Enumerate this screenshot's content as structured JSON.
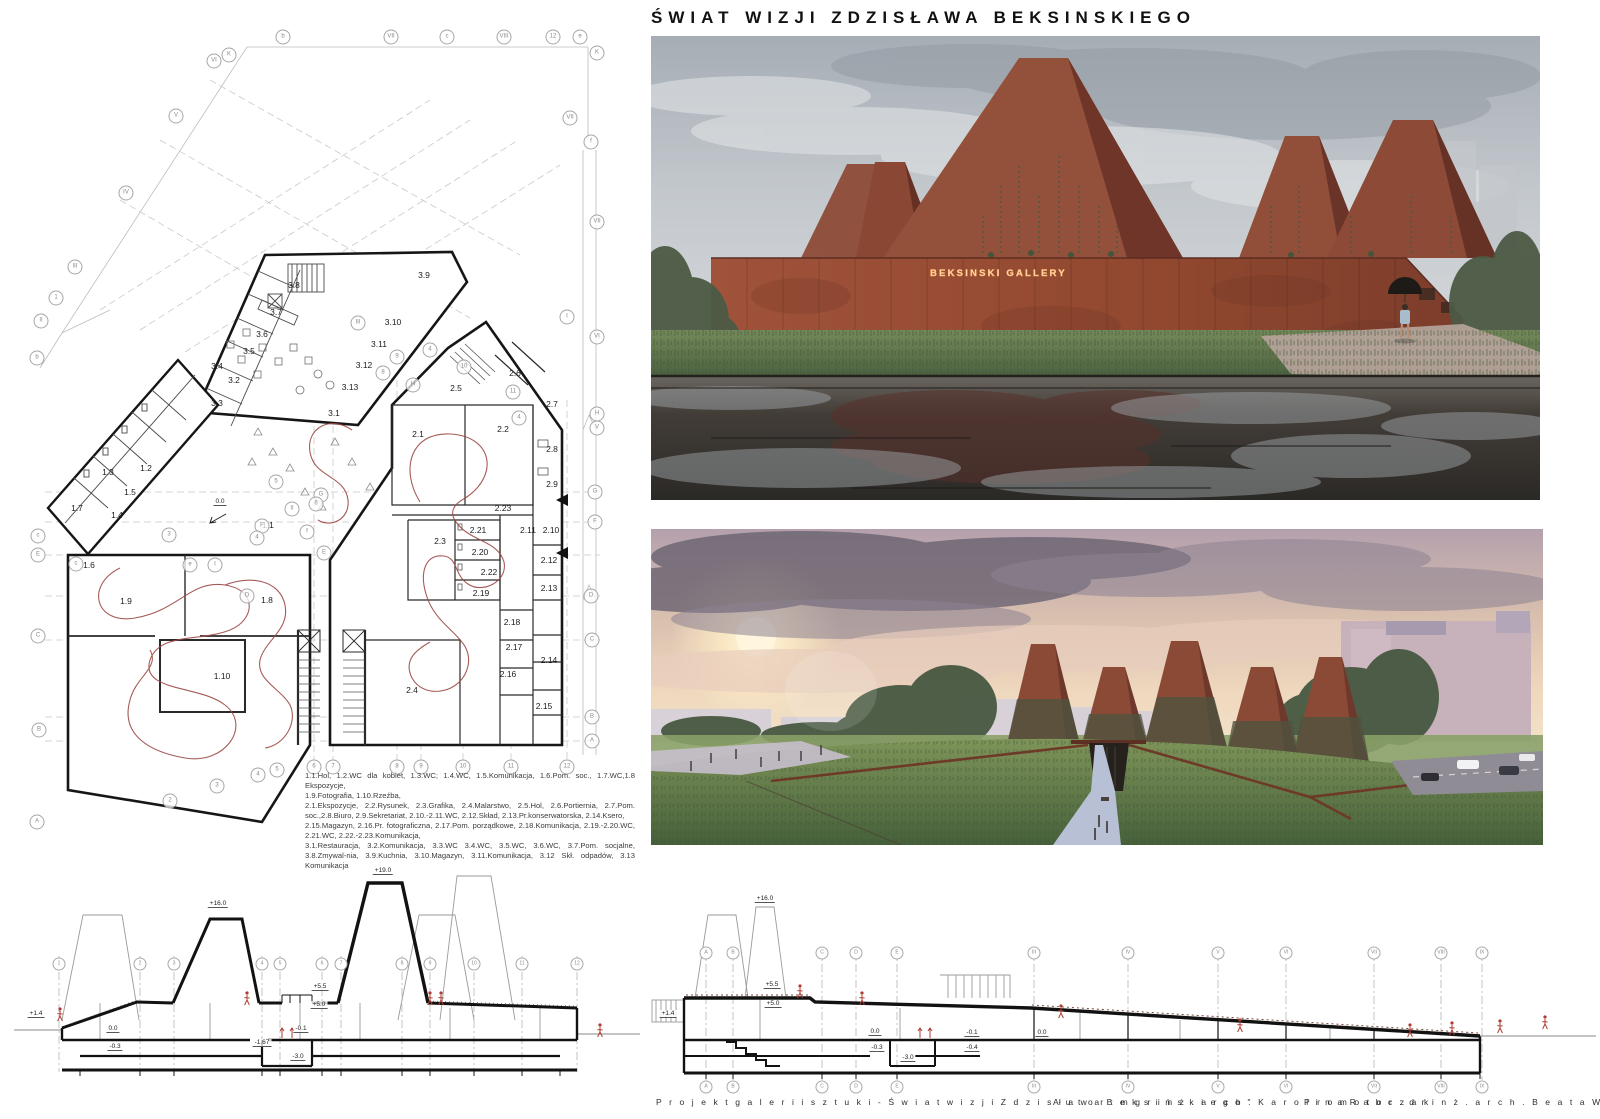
{
  "title": "ŚWIAT WIZJI ZDZISŁAWA BEKSINSKIEGO",
  "renders": {
    "gallery_sign": "BEKSINSKI GALLERY"
  },
  "footer": {
    "project": "P r o j e k t   g a l e r i i   s z t u k i -   Ś w i a t   w i z j i   Z d z i s ł a w a   B e k s i ń s k i e g o \"",
    "author": "A u t o r :   m g r   i n ż .   a r c h .   K a r o l i n a   R a b c z a k",
    "promoter": "P r o m o t o r :   d r   i n ż .   a r c h .   B e a t a   W a l i c k a - G ó r a l"
  },
  "plan": {
    "entry_level": "0.0",
    "rooms": [
      {
        "t": "3.8",
        "x": 294,
        "y": 285
      },
      {
        "t": "3.9",
        "x": 424,
        "y": 275
      },
      {
        "t": "3.7",
        "x": 276,
        "y": 312
      },
      {
        "t": "3.10",
        "x": 393,
        "y": 322
      },
      {
        "t": "3.6",
        "x": 262,
        "y": 334
      },
      {
        "t": "3.11",
        "x": 379,
        "y": 344
      },
      {
        "t": "3.5",
        "x": 249,
        "y": 351
      },
      {
        "t": "3.12",
        "x": 364,
        "y": 365
      },
      {
        "t": "3.4",
        "x": 217,
        "y": 366
      },
      {
        "t": "3.2",
        "x": 234,
        "y": 380
      },
      {
        "t": "3.13",
        "x": 350,
        "y": 387
      },
      {
        "t": "3.3",
        "x": 217,
        "y": 403
      },
      {
        "t": "3.1",
        "x": 334,
        "y": 413
      },
      {
        "t": "1.3",
        "x": 108,
        "y": 472
      },
      {
        "t": "1.2",
        "x": 146,
        "y": 468
      },
      {
        "t": "1.5",
        "x": 130,
        "y": 492
      },
      {
        "t": "1.7",
        "x": 77,
        "y": 508
      },
      {
        "t": "1.4",
        "x": 117,
        "y": 515
      },
      {
        "t": "1.6",
        "x": 89,
        "y": 565
      },
      {
        "t": "1.1",
        "x": 268,
        "y": 525
      },
      {
        "t": "1.9",
        "x": 126,
        "y": 601
      },
      {
        "t": "1.8",
        "x": 267,
        "y": 600
      },
      {
        "t": "1.10",
        "x": 222,
        "y": 676
      },
      {
        "t": "2.1",
        "x": 418,
        "y": 434
      },
      {
        "t": "2.2",
        "x": 503,
        "y": 429
      },
      {
        "t": "2.5",
        "x": 456,
        "y": 388
      },
      {
        "t": "2.6",
        "x": 515,
        "y": 373
      },
      {
        "t": "2.7",
        "x": 552,
        "y": 404
      },
      {
        "t": "2.8",
        "x": 552,
        "y": 449
      },
      {
        "t": "2.9",
        "x": 552,
        "y": 484
      },
      {
        "t": "2.23",
        "x": 503,
        "y": 508
      },
      {
        "t": "2.21",
        "x": 478,
        "y": 530
      },
      {
        "t": "2.3",
        "x": 440,
        "y": 541
      },
      {
        "t": "2.11",
        "x": 528,
        "y": 530
      },
      {
        "t": "2.10",
        "x": 551,
        "y": 530
      },
      {
        "t": "2.20",
        "x": 480,
        "y": 552
      },
      {
        "t": "2.22",
        "x": 489,
        "y": 572
      },
      {
        "t": "2.12",
        "x": 549,
        "y": 560
      },
      {
        "t": "2.19",
        "x": 481,
        "y": 593
      },
      {
        "t": "2.13",
        "x": 549,
        "y": 588
      },
      {
        "t": "2.18",
        "x": 512,
        "y": 622
      },
      {
        "t": "2.17",
        "x": 514,
        "y": 647
      },
      {
        "t": "2.16",
        "x": 508,
        "y": 674
      },
      {
        "t": "2.14",
        "x": 549,
        "y": 660
      },
      {
        "t": "2.4",
        "x": 412,
        "y": 690
      },
      {
        "t": "2.15",
        "x": 544,
        "y": 706
      }
    ],
    "bubbles": [
      {
        "t": "VI",
        "x": 214,
        "y": 61
      },
      {
        "t": "K",
        "x": 229,
        "y": 55
      },
      {
        "t": "b",
        "x": 283,
        "y": 37
      },
      {
        "t": "VII",
        "x": 391,
        "y": 37
      },
      {
        "t": "c",
        "x": 447,
        "y": 37
      },
      {
        "t": "VIII",
        "x": 504,
        "y": 37
      },
      {
        "t": "12",
        "x": 553,
        "y": 37
      },
      {
        "t": "e",
        "x": 580,
        "y": 37
      },
      {
        "t": "K",
        "x": 597,
        "y": 53
      },
      {
        "t": "V",
        "x": 176,
        "y": 116
      },
      {
        "t": "IV",
        "x": 126,
        "y": 193
      },
      {
        "t": "III",
        "x": 75,
        "y": 267
      },
      {
        "t": "1",
        "x": 56,
        "y": 298
      },
      {
        "t": "II",
        "x": 41,
        "y": 321
      },
      {
        "t": "b",
        "x": 37,
        "y": 358
      },
      {
        "t": "c",
        "x": 38,
        "y": 536
      },
      {
        "t": "E",
        "x": 38,
        "y": 555
      },
      {
        "t": "C",
        "x": 38,
        "y": 636
      },
      {
        "t": "B",
        "x": 39,
        "y": 730
      },
      {
        "t": "A",
        "x": 37,
        "y": 822
      },
      {
        "t": "VII",
        "x": 570,
        "y": 118
      },
      {
        "t": "f",
        "x": 591,
        "y": 142
      },
      {
        "t": "VII",
        "x": 597,
        "y": 222
      },
      {
        "t": "I",
        "x": 567,
        "y": 317
      },
      {
        "t": "VI",
        "x": 597,
        "y": 337
      },
      {
        "t": "H",
        "x": 597,
        "y": 414
      },
      {
        "t": "V",
        "x": 597,
        "y": 428
      },
      {
        "t": "G",
        "x": 595,
        "y": 492
      },
      {
        "t": "F",
        "x": 595,
        "y": 522
      },
      {
        "t": "D",
        "x": 591,
        "y": 596
      },
      {
        "t": "C",
        "x": 592,
        "y": 640
      },
      {
        "t": "B",
        "x": 592,
        "y": 717
      },
      {
        "t": "A",
        "x": 592,
        "y": 741
      },
      {
        "t": "2",
        "x": 170,
        "y": 801
      },
      {
        "t": "3",
        "x": 217,
        "y": 786
      },
      {
        "t": "4",
        "x": 258,
        "y": 775
      },
      {
        "t": "5",
        "x": 277,
        "y": 770
      },
      {
        "t": "6",
        "x": 314,
        "y": 767
      },
      {
        "t": "7",
        "x": 333,
        "y": 767
      },
      {
        "t": "8",
        "x": 397,
        "y": 767
      },
      {
        "t": "9",
        "x": 421,
        "y": 767
      },
      {
        "t": "10",
        "x": 463,
        "y": 767
      },
      {
        "t": "11",
        "x": 511,
        "y": 767
      },
      {
        "t": "12",
        "x": 567,
        "y": 767
      },
      {
        "t": "5",
        "x": 276,
        "y": 482
      },
      {
        "t": "II",
        "x": 292,
        "y": 509
      },
      {
        "t": "G",
        "x": 321,
        "y": 495
      },
      {
        "t": "6",
        "x": 316,
        "y": 504
      },
      {
        "t": "F",
        "x": 262,
        "y": 526
      },
      {
        "t": "4",
        "x": 257,
        "y": 538
      },
      {
        "t": "f",
        "x": 307,
        "y": 532
      },
      {
        "t": "E",
        "x": 324,
        "y": 553
      },
      {
        "t": "e",
        "x": 190,
        "y": 565
      },
      {
        "t": "I",
        "x": 215,
        "y": 565
      },
      {
        "t": "3",
        "x": 169,
        "y": 535
      },
      {
        "t": "D",
        "x": 247,
        "y": 596
      },
      {
        "t": "c",
        "x": 76,
        "y": 564
      },
      {
        "t": "9",
        "x": 397,
        "y": 357
      },
      {
        "t": "8",
        "x": 383,
        "y": 373
      },
      {
        "t": "4",
        "x": 430,
        "y": 350
      },
      {
        "t": "10",
        "x": 464,
        "y": 367
      },
      {
        "t": "11",
        "x": 513,
        "y": 392
      },
      {
        "t": "4",
        "x": 519,
        "y": 418
      },
      {
        "t": "H",
        "x": 413,
        "y": 385
      },
      {
        "t": "III",
        "x": 358,
        "y": 323
      }
    ],
    "levels": [
      {
        "t": "0.0",
        "x": 220,
        "y": 506
      }
    ],
    "legend": [
      {
        "t": "1.1.Hol,  1.2.WC  dla kobiet,  1.3.WC;  1.4.WC,  1.5.Komunikacja,  1.6.Pom.  soc.,  1.7.WC,1.8  Ekspozycje,"
      },
      {
        "t": "1.9.Fotografia, 1.10.Rzeźba,"
      },
      {
        "t": "2.1.Ekspozycje,  2.2.Rysunek,  2.3.Grafika,  2.4.Malarstwo,  2.5.Hol,  2.6.Portiernia,  2.7.Pom. soc.,2.8.Biuro,  2.9.Sekretariat,  2.10.-2.11.WC,  2.12.Skład,  2.13.Pr.konserwatorska,  2.14.Ksero,"
      },
      {
        "t": "2.15.Magazyn,  2.16.Pr.  fotograficzna,  2.17.Pom.  porządkowe,  2.18.Komunikacja,  2.19.-2.20.WC, 2.21.WC, 2.22.-2.23.Komunikacja,"
      },
      {
        "t": "3.1.Restauracja, 3.2.Komunikacja, 3.3.WC 3.4.WC, 3.5.WC, 3.6.WC, 3.7.Pom. socjalne, 3.8.Zmywal-nia, 3.9.Kuchnia, 3.10.Magazyn, 3.11.Komunikacja, 3.12 Skł. odpadów, 3.13 Komunikacja"
      }
    ]
  },
  "section_left": {
    "bubbles": [
      {
        "t": "1",
        "x": 59,
        "y": 964
      },
      {
        "t": "2",
        "x": 140,
        "y": 964
      },
      {
        "t": "3",
        "x": 174,
        "y": 964
      },
      {
        "t": "4",
        "x": 262,
        "y": 964
      },
      {
        "t": "5",
        "x": 280,
        "y": 964
      },
      {
        "t": "6",
        "x": 322,
        "y": 964
      },
      {
        "t": "7",
        "x": 341,
        "y": 964
      },
      {
        "t": "8",
        "x": 402,
        "y": 964
      },
      {
        "t": "9",
        "x": 430,
        "y": 964
      },
      {
        "t": "10",
        "x": 474,
        "y": 964
      },
      {
        "t": "11",
        "x": 522,
        "y": 964
      },
      {
        "t": "12",
        "x": 577,
        "y": 964
      }
    ],
    "levels": [
      {
        "t": "+16.0",
        "x": 218,
        "y": 908
      },
      {
        "t": "+19.0",
        "x": 383,
        "y": 875
      },
      {
        "t": "+5.5",
        "x": 320,
        "y": 991
      },
      {
        "t": "+5.0",
        "x": 319,
        "y": 1009
      },
      {
        "t": "0.0",
        "x": 113,
        "y": 1033
      },
      {
        "t": "-0.3",
        "x": 115,
        "y": 1051
      },
      {
        "t": "-1.67",
        "x": 262,
        "y": 1047
      },
      {
        "t": "-3.0",
        "x": 298,
        "y": 1061
      },
      {
        "t": "-0.1",
        "x": 301,
        "y": 1033
      },
      {
        "t": "+1.4",
        "x": 36,
        "y": 1018
      }
    ]
  },
  "section_right": {
    "bubbles": [
      {
        "t": "A",
        "x": 706
      },
      {
        "t": "B",
        "x": 733
      },
      {
        "t": "C",
        "x": 822
      },
      {
        "t": "D",
        "x": 856
      },
      {
        "t": "E",
        "x": 897
      },
      {
        "t": "III",
        "x": 1034
      },
      {
        "t": "IV",
        "x": 1128
      },
      {
        "t": "V",
        "x": 1218
      },
      {
        "t": "VI",
        "x": 1286
      },
      {
        "t": "VII",
        "x": 1374
      },
      {
        "t": "VIII",
        "x": 1441
      },
      {
        "t": "IX",
        "x": 1482
      }
    ],
    "levels": [
      {
        "t": "+16.0",
        "x": 765,
        "y": 903
      },
      {
        "t": "+5.5",
        "x": 772,
        "y": 989
      },
      {
        "t": "+5.0",
        "x": 773,
        "y": 1008
      },
      {
        "t": "0.0",
        "x": 875,
        "y": 1036
      },
      {
        "t": "-0.3",
        "x": 877,
        "y": 1052
      },
      {
        "t": "-3.0",
        "x": 908,
        "y": 1062
      },
      {
        "t": "-0.1",
        "x": 972,
        "y": 1037
      },
      {
        "t": "-0.4",
        "x": 972,
        "y": 1052
      },
      {
        "t": "0.0",
        "x": 1042,
        "y": 1037
      },
      {
        "t": "+1.4",
        "x": 668,
        "y": 1018
      }
    ]
  },
  "colors": {
    "rust": "#8f4a36",
    "rust_dark": "#5f3026",
    "wall": "#9a4e36",
    "water_dark": "#2e2b28",
    "grass": "#61784a",
    "sky_grey": "#b4bac0",
    "sunset": "#eccdb2",
    "figure_red": "#b03a30",
    "path_red": "#9c4a46"
  }
}
